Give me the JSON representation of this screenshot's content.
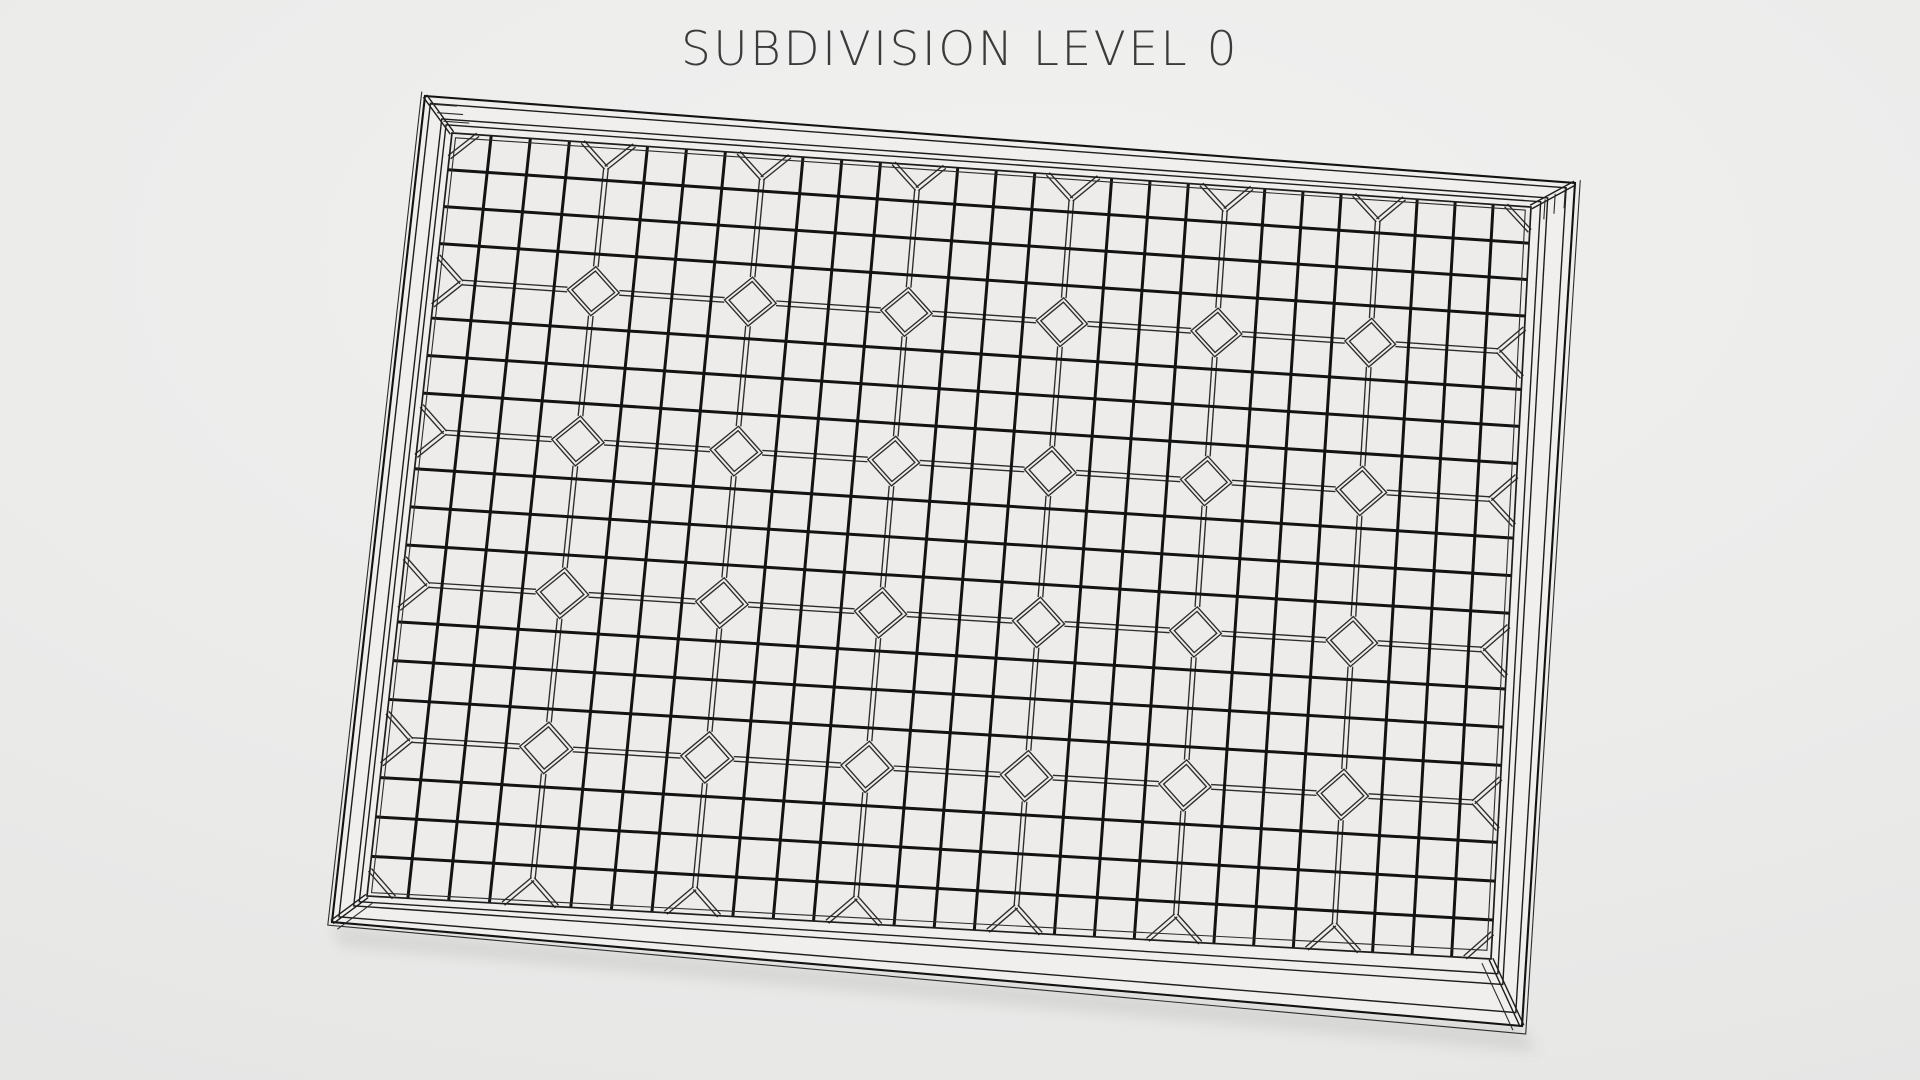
{
  "title": "SUBDIVISION LEVEL 0",
  "viewport": {
    "width": 1920,
    "height": 1080
  },
  "scene": {
    "object": "solar-panel",
    "render_style": "wireframe",
    "subdivision_level": 0,
    "grid": {
      "cells_x": 7,
      "cells_y": 5,
      "subdiv_per_cell": 4,
      "corner_cut": 0.66,
      "diamond_inner_scale": 0.82
    },
    "outer_corners": [
      [
        425,
        96
      ],
      [
        1575,
        183
      ],
      [
        1522,
        1026
      ],
      [
        332,
        922
      ]
    ],
    "glass_corners": [
      [
        452,
        133
      ],
      [
        1531,
        207
      ],
      [
        1491,
        959
      ],
      [
        367,
        896
      ]
    ],
    "frame_line_insets": [
      0.2,
      0.62,
      0.78
    ],
    "outer_skirt_inset": -0.12,
    "inner_lip_inset": 1.13,
    "double_line_gap": 4.6,
    "colors": {
      "background_center": "#f1f1f0",
      "background_edge": "#e1e1e0",
      "frame_fill": "#f0efee",
      "glass_fill": "#edeceb",
      "line_bold": "#131313",
      "line_medium": "#1d1d1d",
      "line_thin": "#2c2c2c",
      "title_text": "#3b3b3b",
      "shadow": "#555555"
    }
  }
}
